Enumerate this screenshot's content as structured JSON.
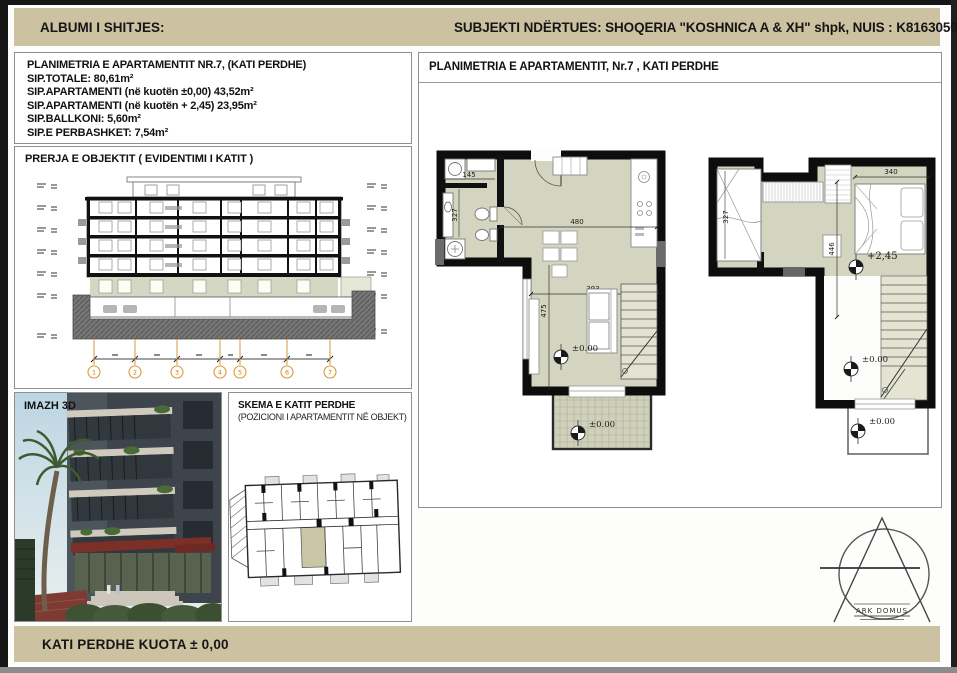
{
  "colors": {
    "band_bg": "#ccc1a0",
    "floor_fill": "#d3d4bf",
    "wall": "#0d0d0d",
    "grid_accent": "#d79a44",
    "panel_border": "#8f8f8f"
  },
  "header": {
    "left": "ALBUMI I SHITJES:",
    "right": "SUBJEKTI NDËRTUES:  SHOQERIA \"KOSHNICA A & XH\" shpk, NUIS : K81630502E"
  },
  "info_box": {
    "title": "PLANIMETRIA E APARTAMENTIT NR.7, (KATI PERDHE)",
    "lines": [
      "SIP.TOTALE: 80,61m²",
      "SIP.APARTAMENTI (në kuotën ±0,00) 43,52m²",
      "SIP.APARTAMENTI (në kuotën + 2,45) 23,95m²",
      "SIP.BALLKONI: 5,60m²",
      "SIP.E PERBASHKET: 7,54m²"
    ]
  },
  "section_box": {
    "title": "PRERJA E OBJEKTIT ( EVIDENTIMI I KATIT )",
    "grid_bubbles": [
      "1",
      "2",
      "3",
      "4",
      "5",
      "6",
      "7"
    ]
  },
  "image3d": {
    "label": "IMAZH 3D"
  },
  "skema": {
    "title": "SKEMA E KATIT PERDHE",
    "subtitle": "(POZICIONI I APARTAMENTIT NË OBJEKT)"
  },
  "plans": {
    "title": "PLANIMETRIA E APARTAMENTIT, Nr.7 , KATI PERDHE",
    "plan1": {
      "dim_145": "145",
      "dim_327": "327",
      "dim_480": "480",
      "dim_393": "393",
      "dim_475": "475",
      "level_main": "±0.00",
      "level_balcony": "±0.00"
    },
    "plan2": {
      "dim_340": "340",
      "dim_327": "327",
      "dim_446": "446",
      "level_upper": "+2,45",
      "level_void": "±0.00",
      "level_balcony": "±0.00"
    }
  },
  "logo": {
    "text": "ARK DOMUS"
  },
  "footer": {
    "text": "KATI PERDHE  KUOTA ± 0,00"
  }
}
